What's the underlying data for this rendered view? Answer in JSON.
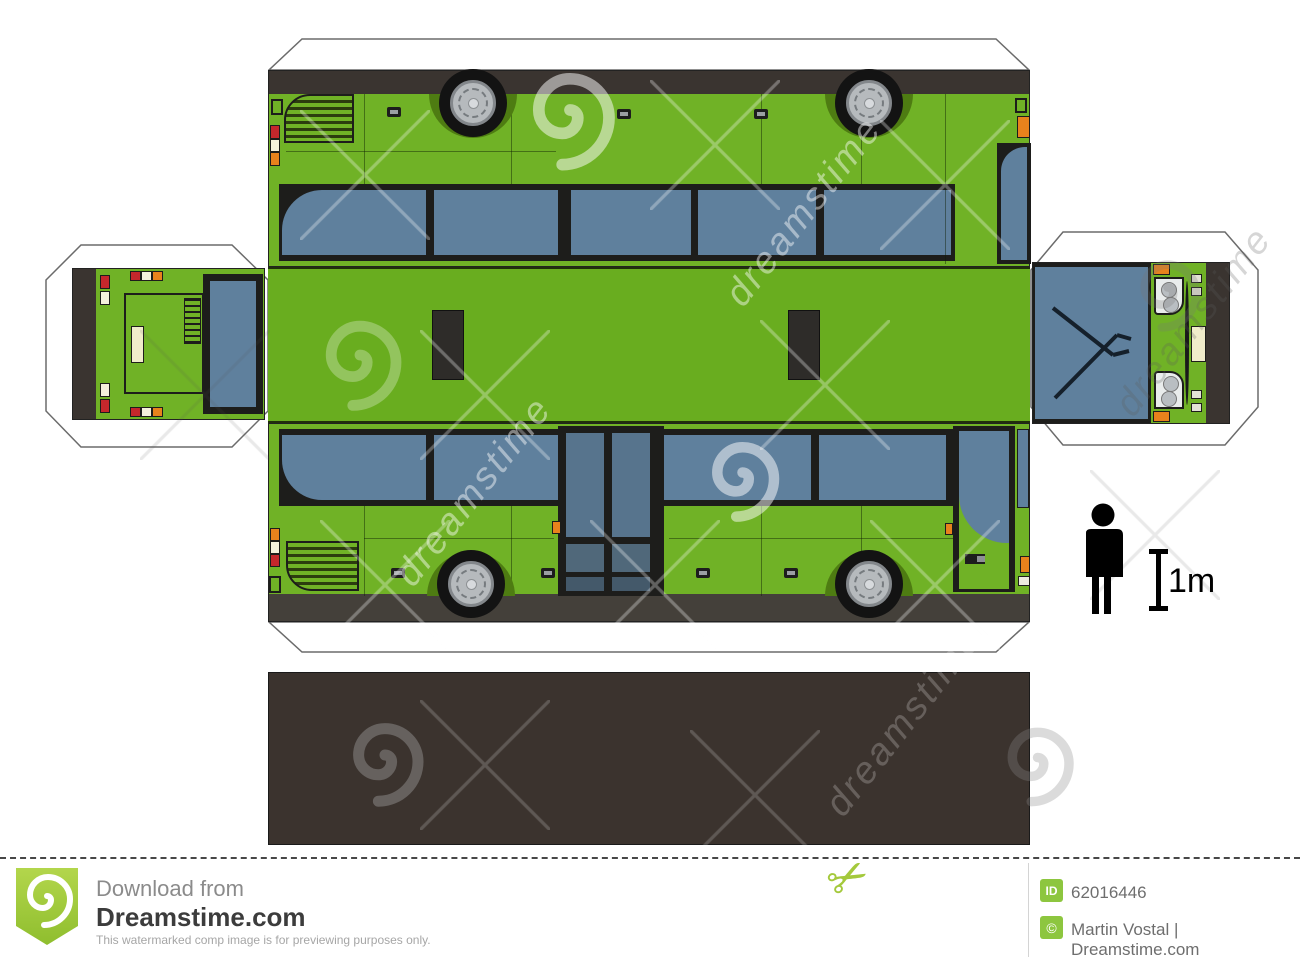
{
  "page": {
    "description": "Paper model of a green bus, papercraft cut-out template preview",
    "background": "#ffffff"
  },
  "model": {
    "bus_green": "#70b226",
    "roof_green": "#69ad1f",
    "trim_dark": "#3a3430",
    "window_glass": "#5f809d",
    "floor_dark": "#3b332e",
    "accent_orange": "#e8821c",
    "accent_red": "#c5272c",
    "license_plate_cream": "#f0ecca"
  },
  "scale_indicator": {
    "label": "1m"
  },
  "watermark": {
    "text": "dreamstime"
  },
  "footer": {
    "download_heading": "Download from",
    "site_name": "Dreamstime.com",
    "disclaimer": "This watermarked comp image is for previewing purposes only.",
    "id_label": "ID",
    "image_id": "62016446",
    "copyright_symbol": "©",
    "credit": "Martin Vostal | Dreamstime.com",
    "brand_green": "#8dc63f",
    "scissors_icon": "✂"
  }
}
